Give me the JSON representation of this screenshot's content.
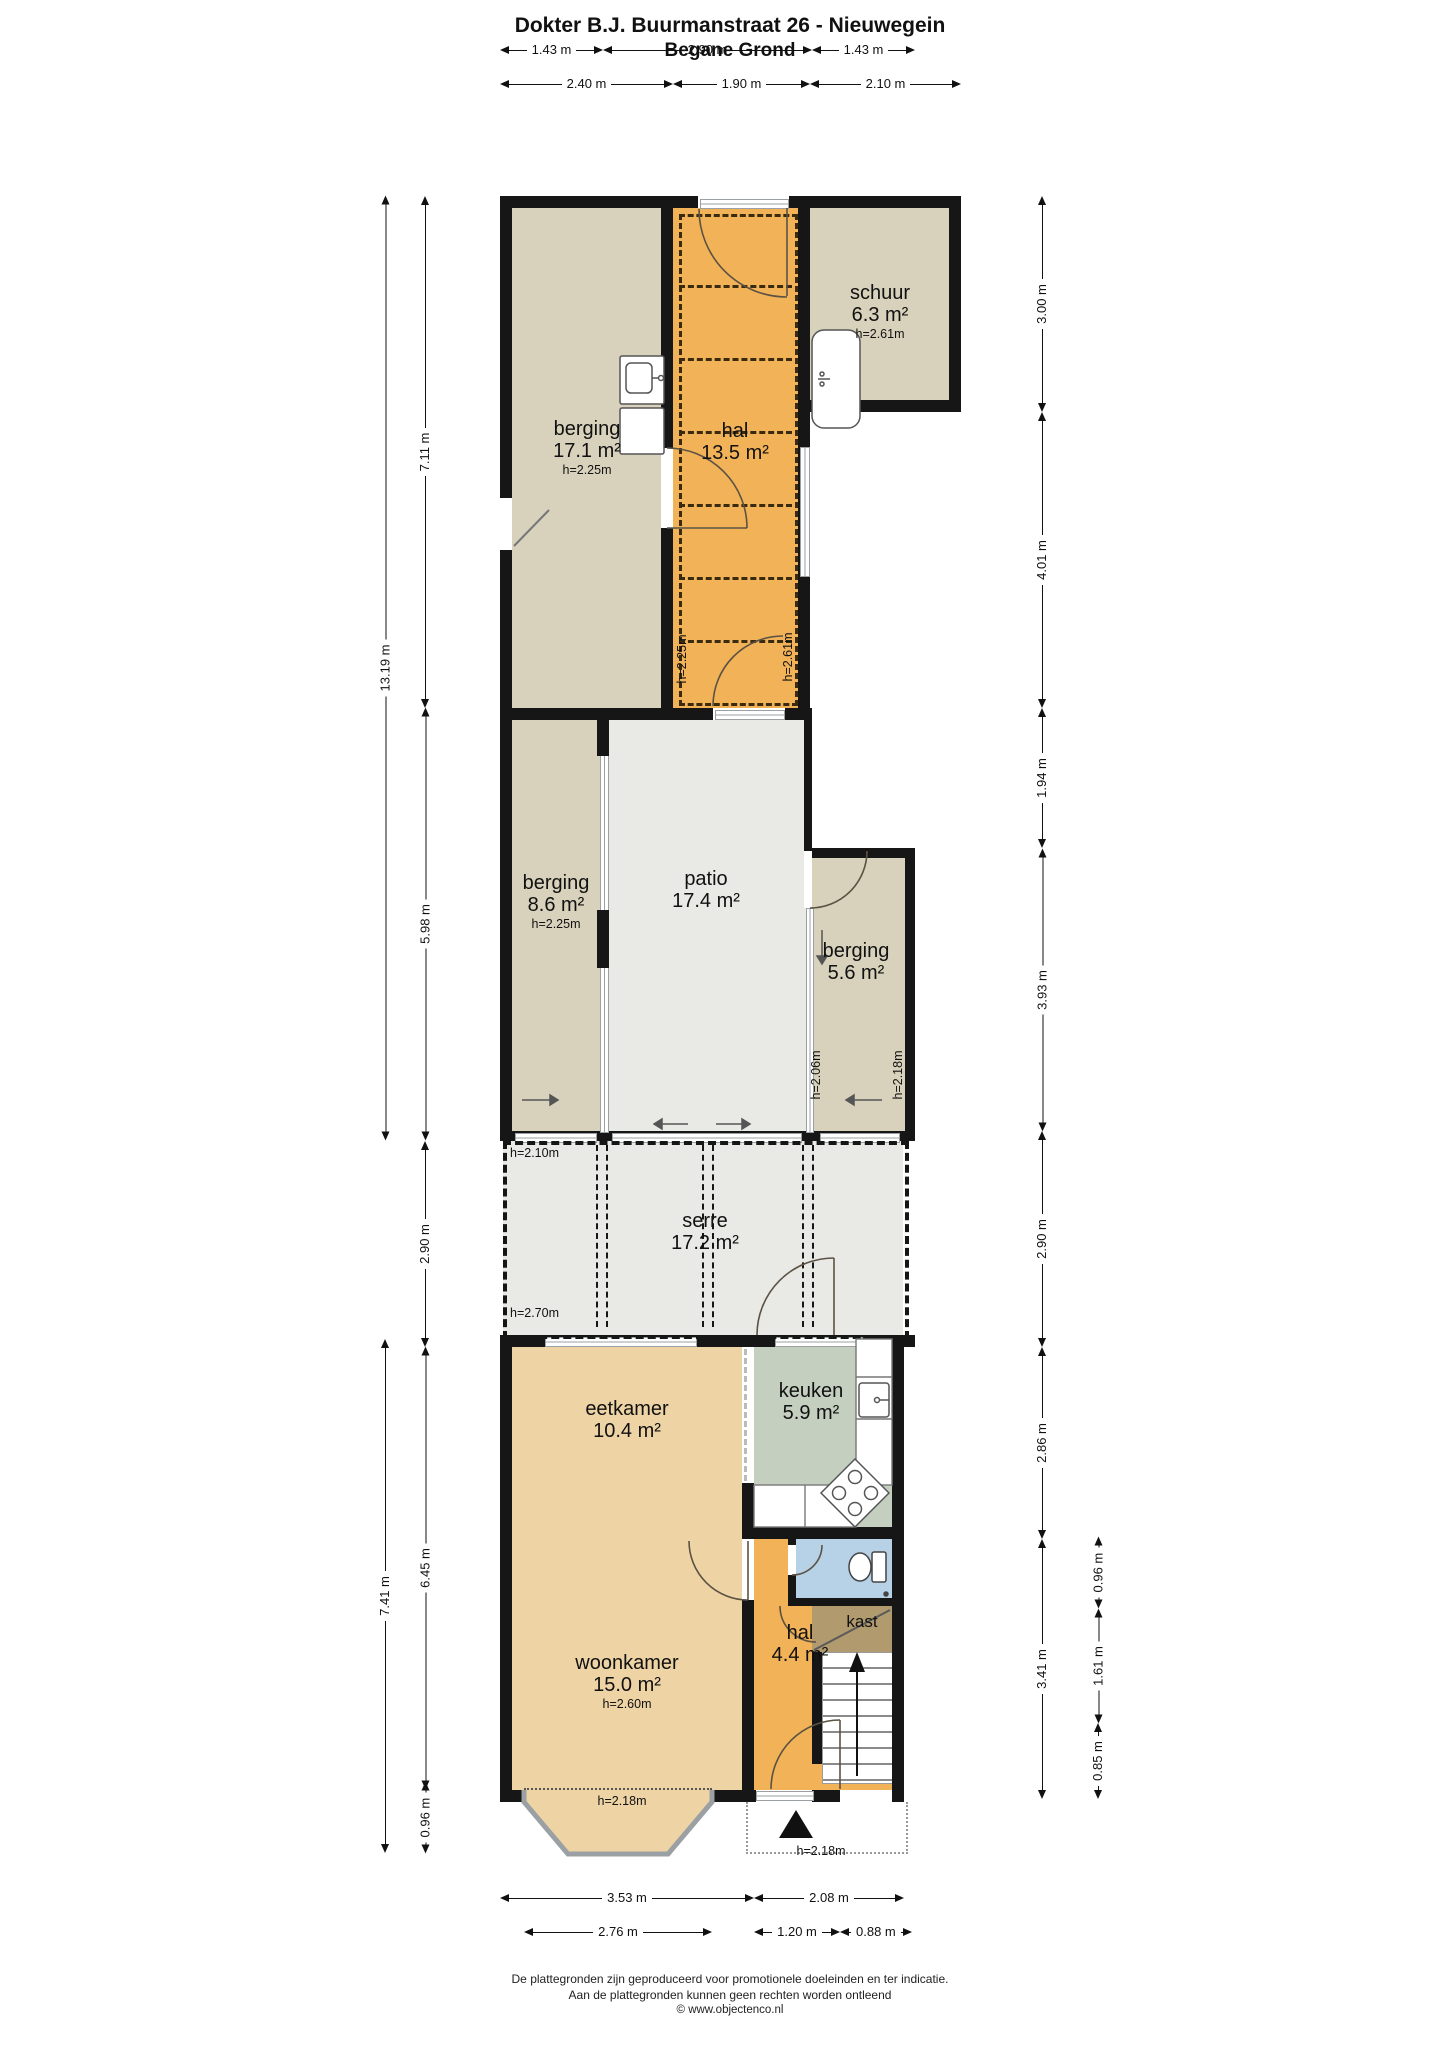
{
  "title": {
    "line1": "Dokter B.J. Buurmanstraat 26 - Nieuwegein",
    "line2": "Begane Grond"
  },
  "dims": {
    "top1": [
      "1.43 m",
      "2.90 m",
      "1.43 m"
    ],
    "top2": [
      "2.40 m",
      "1.90 m",
      "2.10 m"
    ],
    "left_outer": [
      "13.19 m",
      "7.41 m"
    ],
    "left_inner": [
      "7.11 m",
      "5.98 m",
      "2.90 m",
      "6.45 m",
      "0.96 m"
    ],
    "right_inner": [
      "3.00 m",
      "4.01 m",
      "1.94 m",
      "3.93 m",
      "2.90 m",
      "2.86 m",
      "3.41 m"
    ],
    "right_outer": [
      "0.96 m",
      "1.61 m",
      "0.85 m"
    ],
    "bottom1": [
      "3.53 m",
      "2.08 m"
    ],
    "bottom2": [
      "2.76 m",
      "1.20 m",
      "0.88 m"
    ]
  },
  "rooms": {
    "schuur": {
      "name": "schuur",
      "area": "6.3 m²",
      "height": "h=2.61m"
    },
    "berging_achter": {
      "name": "berging",
      "area": "17.1 m²",
      "height": "h=2.25m"
    },
    "hal_boven": {
      "name": "hal",
      "area": "13.5 m²"
    },
    "berging_links": {
      "name": "berging",
      "area": "8.6 m²",
      "height": "h=2.25m"
    },
    "patio": {
      "name": "patio",
      "area": "17.4 m²"
    },
    "berging_rechts": {
      "name": "berging",
      "area": "5.6 m²"
    },
    "serre": {
      "name": "serre",
      "area": "17.2 m²"
    },
    "eetkamer": {
      "name": "eetkamer",
      "area": "10.4 m²"
    },
    "keuken": {
      "name": "keuken",
      "area": "5.9 m²"
    },
    "woonkamer": {
      "name": "woonkamer",
      "area": "15.0 m²",
      "height": "h=2.60m"
    },
    "hal": {
      "name": "hal",
      "area": "4.4 m²"
    },
    "kast": {
      "name": "kast"
    }
  },
  "height_labels": {
    "hal_left": "h=2.25m",
    "hal_right": "h=2.61m",
    "patio_right": "h=2.06m",
    "berging_right": "h=2.18m",
    "serre_top": "h=2.10m",
    "serre_bottom": "h=2.70m",
    "bay_window": "h=2.18m",
    "entrance": "h=2.18m"
  },
  "footer": {
    "line1": "De plattegronden zijn geproduceerd voor promotionele doeleinden en ter indicatie.",
    "line2": "Aan de plattegronden kunnen geen rechten worden ontleend",
    "line3": "© www.objectenco.nl"
  },
  "colors": {
    "wall": "#161616",
    "beige": "#d8d2bc",
    "orange": "#f2b257",
    "tan": "#eed3a4",
    "green": "#c5cfbf",
    "blue": "#b7d2e7",
    "brown": "#b09a6e",
    "grey": "#e9e9e6",
    "glass": "#9aa0a3"
  }
}
